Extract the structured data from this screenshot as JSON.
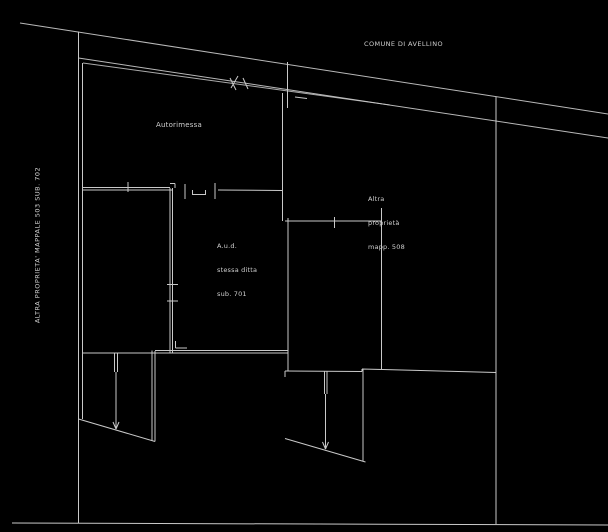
{
  "drawing": {
    "background_color": "#000000",
    "line_color": "#c9c9c9",
    "text_color": "#cfcfcf",
    "labels": {
      "municipality": "COMUNE DI AVELLINO",
      "garage": "Autorimessa",
      "aud": {
        "lines": [
          "A.u.d.",
          "stessa ditta",
          "sub. 701"
        ]
      },
      "other_property_right": {
        "lines": [
          "Altra",
          "proprietà",
          "mapp. 508"
        ]
      },
      "other_property_left": "ALTRA PROPRIETA' MAPPALE 503 SUB. 702"
    }
  }
}
